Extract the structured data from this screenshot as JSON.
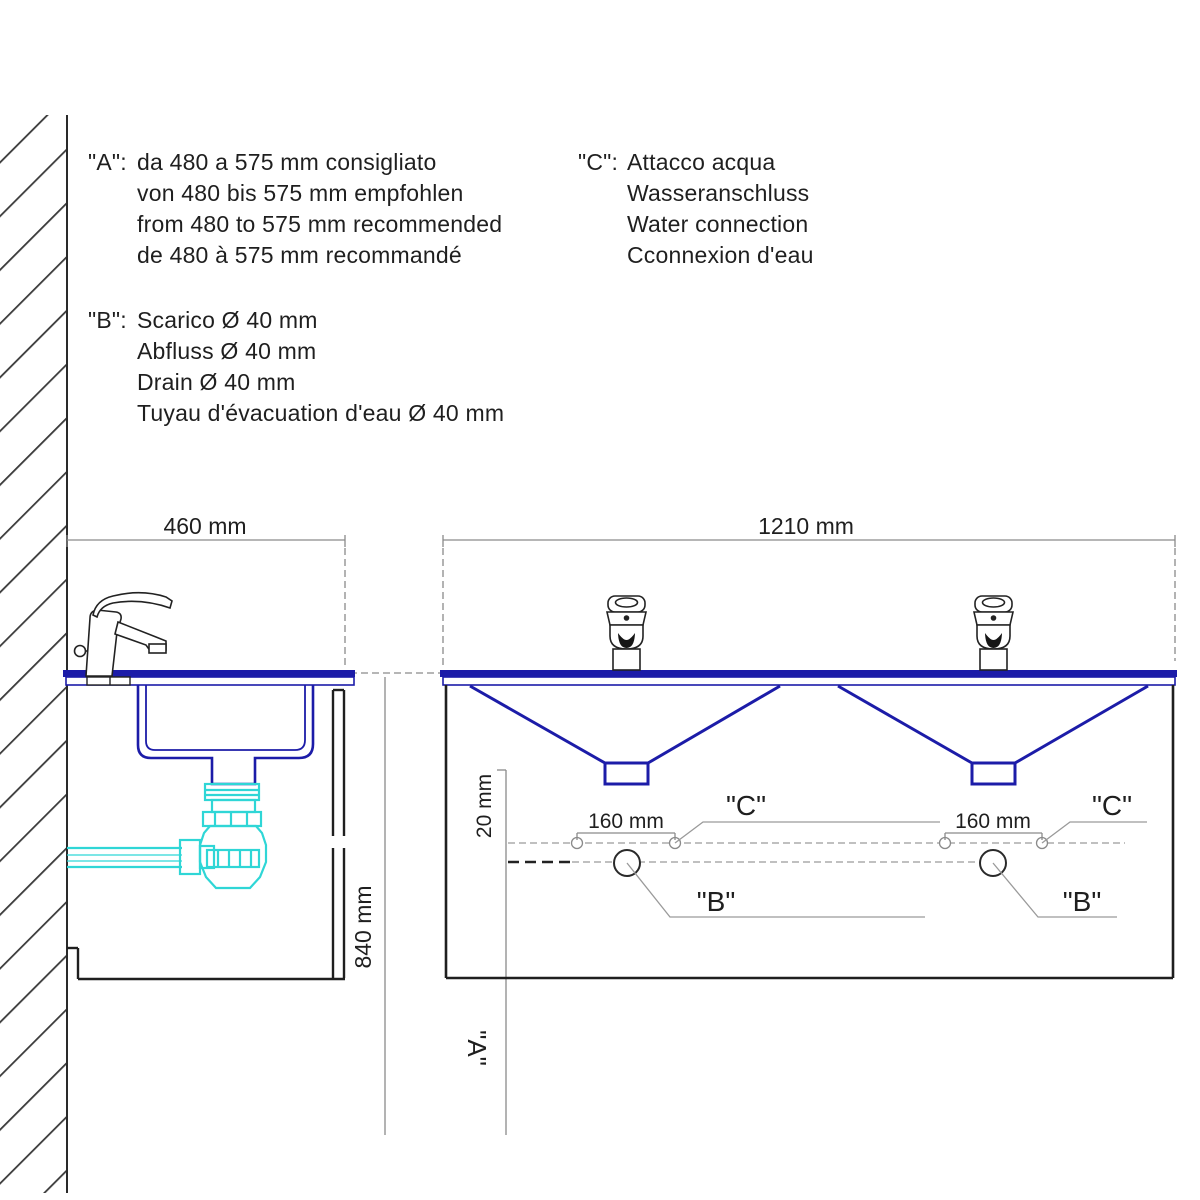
{
  "notes": {
    "a": {
      "key": "\"A\":",
      "lines": [
        "da 480 a 575 mm consigliato",
        "von 480 bis 575 mm empfohlen",
        "from 480 to 575 mm recommended",
        "de 480 à 575 mm recommandé"
      ]
    },
    "b": {
      "key": "\"B\":",
      "lines": [
        "Scarico Ø 40 mm",
        "Abfluss Ø 40 mm",
        "Drain Ø 40 mm",
        "Tuyau d'évacuation d'eau  Ø 40 mm"
      ]
    },
    "c": {
      "key": "\"C\":",
      "lines": [
        "Attacco acqua",
        "Wasseranschluss",
        "Water connection",
        "Cconnexion d'eau"
      ]
    }
  },
  "dimensions": {
    "side_depth": "460 mm",
    "front_width": "1210 mm",
    "height": "840 mm",
    "tap_hole_spacing": "160 mm",
    "connection_offset": "20 mm"
  },
  "refs": {
    "a": "\"A\"",
    "b": "\"B\"",
    "c": "\"C\""
  },
  "colors": {
    "basin_outline": "#1c1ca8",
    "siphon": "#2fd6d6",
    "line": "#1a1a1a",
    "dim_line": "#8a8a8a"
  }
}
